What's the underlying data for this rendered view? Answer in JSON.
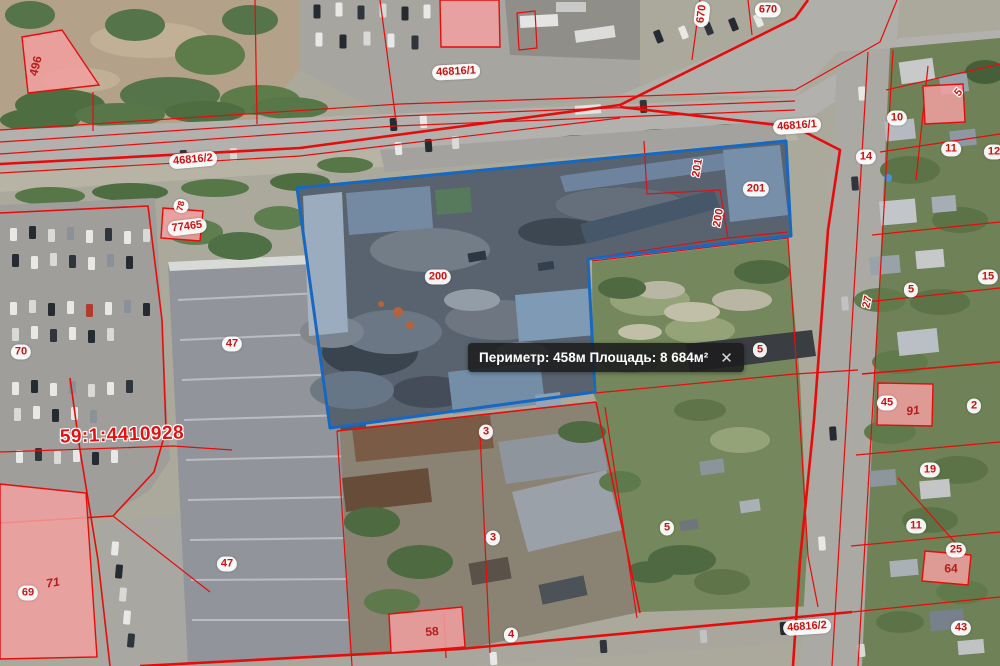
{
  "colors": {
    "cadastral_line_red": "#e60c0c",
    "label_red": "#cc1111",
    "selection_blue": "#1668c0",
    "building_pink": "#f2a0a0",
    "tooltip_bg": "rgba(28,28,30,0.88)"
  },
  "tooltip": {
    "text": "Периметр: 458м Площадь: 8 684м²",
    "perimeter": "458м",
    "area": "8 684м²",
    "close_label": "✕"
  },
  "map": {
    "quarter_number": "59:1:4410928",
    "selected_parcel_labels": [
      "200",
      "201"
    ],
    "labels": [
      {
        "text": "496",
        "x": 36,
        "y": 66,
        "rot": -76,
        "style": "pink"
      },
      {
        "text": "46816/2",
        "x": 193,
        "y": 160,
        "rot": -5,
        "style": "badge"
      },
      {
        "text": "46816/1",
        "x": 456,
        "y": 72,
        "rot": -3,
        "style": "badge"
      },
      {
        "text": "670",
        "x": 702,
        "y": 14,
        "rot": -83,
        "style": "badge"
      },
      {
        "text": "670",
        "x": 768,
        "y": 10,
        "rot": 0,
        "style": "badge"
      },
      {
        "text": "46816/1",
        "x": 797,
        "y": 126,
        "rot": -4,
        "style": "badge"
      },
      {
        "text": "78",
        "x": 181,
        "y": 206,
        "rot": -76,
        "style": "badge small"
      },
      {
        "text": "77465",
        "x": 187,
        "y": 227,
        "rot": -7,
        "style": "badge"
      },
      {
        "text": "70",
        "x": 21,
        "y": 352,
        "rot": 0,
        "style": "badge"
      },
      {
        "text": "47",
        "x": 232,
        "y": 344,
        "rot": 0,
        "style": "badge"
      },
      {
        "text": "59:1:4410928",
        "x": 122,
        "y": 435,
        "rot": -2,
        "style": "quarter"
      },
      {
        "text": "69",
        "x": 28,
        "y": 593,
        "rot": 0,
        "style": "badge"
      },
      {
        "text": "71",
        "x": 53,
        "y": 583,
        "rot": -10,
        "style": "pink italic"
      },
      {
        "text": "47",
        "x": 227,
        "y": 564,
        "rot": 0,
        "style": "badge"
      },
      {
        "text": "200",
        "x": 438,
        "y": 277,
        "rot": 0,
        "style": "badge"
      },
      {
        "text": "3",
        "x": 486,
        "y": 432,
        "rot": 0,
        "style": "badge"
      },
      {
        "text": "3",
        "x": 493,
        "y": 538,
        "rot": 0,
        "style": "badge"
      },
      {
        "text": "58",
        "x": 432,
        "y": 632,
        "rot": -4,
        "style": "pink"
      },
      {
        "text": "4",
        "x": 511,
        "y": 635,
        "rot": 0,
        "style": "badge"
      },
      {
        "text": "5",
        "x": 667,
        "y": 528,
        "rot": 0,
        "style": "badge"
      },
      {
        "text": "5",
        "x": 760,
        "y": 350,
        "rot": 0,
        "style": "badge"
      },
      {
        "text": "201",
        "x": 698,
        "y": 168,
        "rot": -80,
        "style": "plain"
      },
      {
        "text": "201",
        "x": 756,
        "y": 189,
        "rot": 0,
        "style": "badge"
      },
      {
        "text": "200",
        "x": 719,
        "y": 218,
        "rot": -80,
        "style": "plain"
      },
      {
        "text": "10",
        "x": 897,
        "y": 118,
        "rot": 0,
        "style": "badge"
      },
      {
        "text": "14",
        "x": 866,
        "y": 157,
        "rot": 0,
        "style": "badge"
      },
      {
        "text": "11",
        "x": 951,
        "y": 149,
        "rot": 0,
        "style": "badge"
      },
      {
        "text": "12",
        "x": 994,
        "y": 152,
        "rot": 0,
        "style": "badge"
      },
      {
        "text": "5",
        "x": 959,
        "y": 93,
        "rot": -50,
        "style": "plain"
      },
      {
        "text": "15",
        "x": 988,
        "y": 277,
        "rot": 0,
        "style": "badge"
      },
      {
        "text": "5",
        "x": 911,
        "y": 290,
        "rot": 0,
        "style": "badge"
      },
      {
        "text": "27",
        "x": 868,
        "y": 302,
        "rot": -78,
        "style": "plain"
      },
      {
        "text": "45",
        "x": 887,
        "y": 403,
        "rot": 0,
        "style": "badge"
      },
      {
        "text": "91",
        "x": 913,
        "y": 411,
        "rot": -8,
        "style": "pink italic"
      },
      {
        "text": "2",
        "x": 974,
        "y": 406,
        "rot": 0,
        "style": "badge"
      },
      {
        "text": "19",
        "x": 930,
        "y": 470,
        "rot": 0,
        "style": "badge"
      },
      {
        "text": "11",
        "x": 916,
        "y": 526,
        "rot": 0,
        "style": "badge"
      },
      {
        "text": "25",
        "x": 956,
        "y": 550,
        "rot": 0,
        "style": "badge"
      },
      {
        "text": "64",
        "x": 951,
        "y": 569,
        "rot": 0,
        "style": "pink"
      },
      {
        "text": "43",
        "x": 961,
        "y": 628,
        "rot": 0,
        "style": "badge"
      },
      {
        "text": "46816/2",
        "x": 807,
        "y": 627,
        "rot": -4,
        "style": "badge"
      }
    ]
  }
}
